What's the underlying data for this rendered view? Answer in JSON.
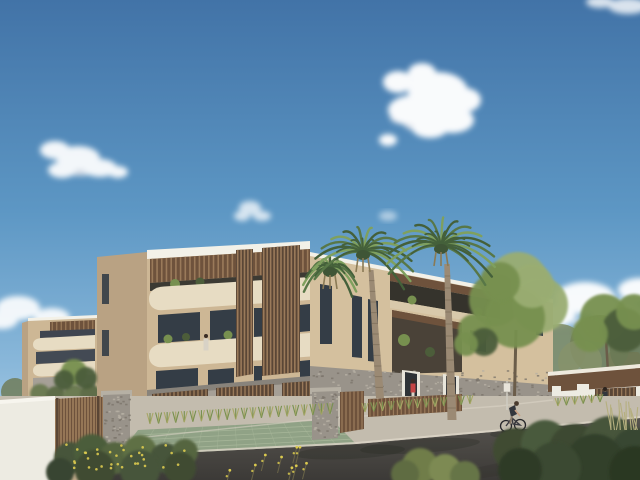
{
  "image": {
    "kind": "architectural-3d-rendering",
    "width": 640,
    "height": 480
  },
  "palette": {
    "sky_top": "#4273a7",
    "sky_mid": "#5d97c4",
    "sky_low": "#8ab8da",
    "sky_horizon": "#b9d6ec",
    "cloud": "#ffffff",
    "cloud_shade": "#d7dde6",
    "fascia": "#f3f1e8",
    "cream": "#e7dcc3",
    "cream_shade": "#d8c9ab",
    "beige": "#cdb795",
    "beige_sun": "#d4c09e",
    "beige_shade": "#b9a283",
    "wood": "#6e523c",
    "wood_light": "#9a7a5a",
    "wood_dark": "#5a4636",
    "window": "#343d46",
    "glass": "#8fa8ba",
    "concrete": "#a6a097",
    "stone": "#99938a",
    "stone_light": "#b6b0a4",
    "stone_dark": "#7c766c",
    "sidewalk": "#c3bcae",
    "curb": "#ddd6c8",
    "road_top": "#57544f",
    "road_bottom": "#3c3a37",
    "ramp": "#c0ab8b",
    "paver_green": "#90a286",
    "paver_line": "#a9b89b",
    "white_wall": "#edebe2",
    "leaf_light": "#9aad72",
    "leaf_mid": "#77904f",
    "leaf_dark": "#4c5d3a",
    "palm_green": "#53724489",
    "palm_stroke_a": "#587747",
    "palm_stroke_b": "#7fa05e",
    "palm_stroke_c": "#44603a",
    "trunk": "#9b8a74",
    "trunk_ring": "#7c6c58",
    "bush_dark": "#3f4c33",
    "grass_yellow": "#a8a766",
    "flower_yellow": "#dbca4f",
    "terracotta": "#9a6048",
    "skin": "#caa184",
    "red_top": "#c54545",
    "dark_fig": "#33363c",
    "shadow": "#23261e"
  },
  "scene": {
    "clouds": [
      {
        "name": "cloud-upper-right",
        "opacity": 0.97,
        "base": [
          [
            430,
            124,
            26,
            9
          ],
          [
            410,
            118,
            20,
            7
          ]
        ],
        "puffs": [
          [
            438,
            92,
            30,
            20
          ],
          [
            414,
            110,
            26,
            15
          ],
          [
            452,
            120,
            22,
            13
          ],
          [
            398,
            82,
            15,
            11
          ],
          [
            430,
            128,
            18,
            10
          ],
          [
            465,
            100,
            16,
            12
          ],
          [
            388,
            140,
            9,
            6
          ],
          [
            422,
            73,
            14,
            10
          ]
        ]
      },
      {
        "name": "cloud-left",
        "opacity": 0.93,
        "base": [
          [
            80,
            170,
            18,
            6
          ]
        ],
        "puffs": [
          [
            55,
            150,
            15,
            9
          ],
          [
            78,
            158,
            22,
            12
          ],
          [
            100,
            168,
            17,
            9
          ],
          [
            62,
            170,
            14,
            8
          ],
          [
            118,
            172,
            10,
            6
          ]
        ]
      },
      {
        "name": "cloud-small-center",
        "opacity": 0.75,
        "base": [],
        "puffs": [
          [
            250,
            208,
            11,
            7
          ],
          [
            262,
            216,
            9,
            5
          ],
          [
            242,
            216,
            8,
            5
          ]
        ]
      },
      {
        "name": "cloud-faint-center",
        "opacity": 0.5,
        "base": [],
        "puffs": [
          [
            388,
            216,
            9,
            5
          ]
        ]
      },
      {
        "name": "cloud-right-low",
        "opacity": 0.95,
        "base": [
          [
            600,
            324,
            26,
            8
          ]
        ],
        "puffs": [
          [
            585,
            298,
            30,
            16
          ],
          [
            618,
            314,
            26,
            14
          ],
          [
            556,
            316,
            20,
            11
          ],
          [
            640,
            290,
            22,
            12
          ],
          [
            600,
            330,
            24,
            10
          ]
        ]
      },
      {
        "name": "cloud-left-low",
        "opacity": 0.9,
        "base": [],
        "puffs": [
          [
            18,
            308,
            22,
            12
          ],
          [
            52,
            318,
            18,
            10
          ],
          [
            2,
            320,
            16,
            9
          ]
        ]
      },
      {
        "name": "cloud-top-right-corner",
        "opacity": 0.8,
        "base": [],
        "puffs": [
          [
            628,
            6,
            20,
            8
          ],
          [
            600,
            2,
            14,
            6
          ]
        ]
      }
    ],
    "slat_sets": [
      {
        "mount": "slats-main-pergola",
        "name": "main-pergola-slats",
        "pts": [
          [
            150,
            259
          ],
          [
            310,
            249
          ],
          [
            310,
            272
          ],
          [
            150,
            283
          ]
        ],
        "count": 34,
        "bg": "wood",
        "line": "wood_light",
        "w": 1.6
      },
      {
        "mount": "slats-leftwing-pergola",
        "name": "leftwing-pergola-slats",
        "pts": [
          [
            50,
            322
          ],
          [
            95,
            320
          ],
          [
            95,
            330
          ],
          [
            50,
            332
          ]
        ],
        "count": 10,
        "bg": "wood",
        "line": "wood_light",
        "w": 1.2
      },
      {
        "mount": "slats-panel1",
        "name": "facade-slat-screen-1",
        "pts": [
          [
            236,
            250
          ],
          [
            253,
            249
          ],
          [
            253,
            374
          ],
          [
            236,
            377
          ]
        ],
        "count": 5,
        "bg": "wood_dark",
        "line": "wood_light",
        "w": 1.6
      },
      {
        "mount": "slats-panel2",
        "name": "facade-slat-screen-2",
        "pts": [
          [
            262,
            248
          ],
          [
            300,
            245
          ],
          [
            300,
            372
          ],
          [
            262,
            376
          ]
        ],
        "count": 11,
        "bg": "wood_dark",
        "line": "wood_light",
        "w": 1.6
      },
      {
        "mount": "slats-g1",
        "name": "garage-screen-1",
        "pts": [
          [
            152,
            394
          ],
          [
            208,
            389
          ],
          [
            208,
            429
          ],
          [
            152,
            434
          ]
        ],
        "count": 14,
        "bg": "wood_dark",
        "line": "wood_light",
        "w": 1.4
      },
      {
        "mount": "slats-g2",
        "name": "garage-screen-2",
        "pts": [
          [
            216,
            388
          ],
          [
            274,
            384
          ],
          [
            274,
            425
          ],
          [
            216,
            430
          ]
        ],
        "count": 15,
        "bg": "wood_dark",
        "line": "wood_light",
        "w": 1.4
      },
      {
        "mount": "slats-g3",
        "name": "garage-screen-3",
        "pts": [
          [
            282,
            383
          ],
          [
            312,
            381
          ],
          [
            312,
            419
          ],
          [
            282,
            423
          ]
        ],
        "count": 8,
        "bg": "wood_dark",
        "line": "wood_light",
        "w": 1.4
      },
      {
        "mount": "slats-lowfence",
        "name": "street-low-fence",
        "pts": [
          [
            368,
            399
          ],
          [
            462,
            394
          ],
          [
            462,
            411
          ],
          [
            368,
            417
          ]
        ],
        "count": 24,
        "bg": "wood",
        "line": "wood_light",
        "w": 1.2
      },
      {
        "mount": "slats-gatepanel",
        "name": "driveway-gate-panel",
        "pts": [
          [
            340,
            392
          ],
          [
            364,
            391
          ],
          [
            364,
            429
          ],
          [
            340,
            433
          ]
        ],
        "count": 6,
        "bg": "wood",
        "line": "wood_light",
        "w": 1.3
      },
      {
        "mount": "slats-carport",
        "name": "carport-opening-slats",
        "pts": [
          [
            595,
            389
          ],
          [
            636,
            387
          ],
          [
            636,
            410
          ],
          [
            595,
            412
          ]
        ],
        "count": 10,
        "bg": "wood_dark",
        "line": "wood_light",
        "w": 1.2
      },
      {
        "mount": "slats-leftfence",
        "name": "timber-fence-slats",
        "pts": [
          [
            55,
            399
          ],
          [
            103,
            396
          ],
          [
            103,
            451
          ],
          [
            55,
            456
          ]
        ],
        "count": 16,
        "bg": "wood_light",
        "line": "wood",
        "w": 1.2
      }
    ],
    "speckle_areas": [
      {
        "mount": "speckles-stone",
        "name": "stone-cladding-texture",
        "x": 312,
        "y": 370,
        "w": 238,
        "h": 30,
        "n": 160,
        "seed": 7
      },
      {
        "mount": "speckles-pillar",
        "name": "stone-pillar-texture",
        "x": 104,
        "y": 396,
        "w": 25,
        "h": 54,
        "n": 60,
        "seed": 11
      },
      {
        "mount": "speckles-midwall",
        "name": "stone-wall-texture",
        "x": 313,
        "y": 393,
        "w": 25,
        "h": 44,
        "n": 50,
        "seed": 13
      }
    ],
    "palms": [
      {
        "mount": "palm3",
        "name": "palm-tree-small",
        "cx": 330,
        "cy": 269,
        "r": 27,
        "n": 12,
        "trunk": null,
        "rings": 0
      },
      {
        "mount": "palms",
        "name": "palm-tree-left",
        "cx": 363,
        "cy": 252,
        "r": 50,
        "n": 15,
        "trunk": [
          371,
          270,
          380,
          398,
          5,
          8
        ],
        "rings": 12
      },
      {
        "mount": "palms",
        "name": "palm-tree-right",
        "cx": 441,
        "cy": 246,
        "r": 54,
        "n": 16,
        "trunk": [
          447,
          264,
          452,
          420,
          5.5,
          9
        ],
        "rings": 13
      }
    ],
    "tree_clusters": [
      {
        "mount": "trees",
        "name": "tree-large-center-right",
        "trunk": [
          514,
          418,
          516,
          330,
          3
        ],
        "circles": [
          [
            518,
            282,
            30,
            "leaf_light"
          ],
          [
            495,
            300,
            26,
            "leaf_mid"
          ],
          [
            540,
            305,
            28,
            "leaf_light"
          ],
          [
            515,
            318,
            30,
            "leaf_mid"
          ],
          [
            532,
            286,
            22,
            "leaf_light"
          ],
          [
            500,
            282,
            20,
            "leaf_mid"
          ]
        ]
      },
      {
        "mount": "trees",
        "name": "tree-small-center",
        "trunk": null,
        "circles": [
          [
            474,
            330,
            16,
            "leaf_mid"
          ],
          [
            484,
            342,
            14,
            "leaf_dark"
          ],
          [
            466,
            344,
            12,
            "leaf_mid"
          ]
        ]
      },
      {
        "mount": "trees",
        "name": "tree-right-edge",
        "trunk": [
          608,
          372,
          606,
          340,
          2.5
        ],
        "circles": [
          [
            604,
            318,
            24,
            "leaf_mid"
          ],
          [
            624,
            330,
            22,
            "leaf_dark"
          ],
          [
            590,
            334,
            18,
            "leaf_mid"
          ],
          [
            634,
            312,
            18,
            "leaf_mid"
          ]
        ]
      },
      {
        "mount": "trees",
        "name": "tree-left-small",
        "trunk": null,
        "circles": [
          [
            74,
            372,
            13,
            "leaf_mid"
          ],
          [
            86,
            378,
            11,
            "leaf_dark"
          ],
          [
            64,
            380,
            10,
            "leaf_dark"
          ]
        ]
      }
    ],
    "bush_clusters": [
      {
        "mount": "bushes-left",
        "name": "foreground-shrubs-left",
        "circles": [
          [
            70,
            458,
            16,
            "#46543a"
          ],
          [
            92,
            452,
            18,
            "#4c5d3a"
          ],
          [
            115,
            458,
            16,
            "#55653f"
          ],
          [
            140,
            452,
            17,
            "#5e6f45"
          ],
          [
            165,
            458,
            15,
            "#46543a"
          ],
          [
            185,
            452,
            13,
            "#55653f"
          ],
          [
            95,
            470,
            20,
            "#3f4c33"
          ],
          [
            140,
            470,
            20,
            "#46553a"
          ],
          [
            180,
            468,
            16,
            "#3f4c33"
          ],
          [
            60,
            472,
            14,
            "#384430"
          ]
        ]
      },
      {
        "mount": "grasses-center",
        "name": "foreground-grasses-center",
        "circles": [
          [
            420,
            466,
            18,
            "#6f7d4a"
          ],
          [
            445,
            470,
            16,
            "#7d8a52"
          ],
          [
            405,
            474,
            14,
            "#5e6c42"
          ],
          [
            465,
            476,
            15,
            "#667446"
          ]
        ]
      },
      {
        "mount": "bushes-right",
        "name": "foreground-bushes-right",
        "circles": [
          [
            515,
            450,
            22,
            "#3f4c33"
          ],
          [
            545,
            444,
            24,
            "#4a5a3c"
          ],
          [
            575,
            450,
            26,
            "#3c4a32"
          ],
          [
            610,
            444,
            28,
            "#46553a"
          ],
          [
            635,
            452,
            24,
            "#394733"
          ],
          [
            595,
            464,
            30,
            "#323f2b"
          ],
          [
            555,
            468,
            26,
            "#3a4830"
          ],
          [
            520,
            470,
            22,
            "#2f3b28"
          ],
          [
            635,
            472,
            26,
            "#2c3724"
          ]
        ]
      },
      {
        "mount": "hedge-left",
        "name": "hedge-left-wing",
        "circles": [
          [
            40,
            394,
            10,
            "#6d7b52"
          ],
          [
            56,
            396,
            10,
            "#5f6d48"
          ],
          [
            74,
            396,
            11,
            "#6d7b52"
          ],
          [
            90,
            394,
            10,
            "#5f6d48"
          ],
          [
            138,
            414,
            9,
            "#4c5d3a"
          ],
          [
            141,
            428,
            10,
            "#46553a"
          ],
          [
            137,
            442,
            9,
            "#3f4c33"
          ]
        ]
      },
      {
        "mount": "carport-bushes",
        "name": "bushes-by-carport",
        "circles": [
          [
            565,
            412,
            13,
            "#55653f"
          ],
          [
            582,
            417,
            14,
            "#4c5d3a"
          ],
          [
            552,
            416,
            10,
            "#5e6f45"
          ]
        ]
      }
    ],
    "grass_rows": [
      {
        "name": "grass-row-driveway",
        "x1": 150,
        "y1": 424,
        "x2": 330,
        "y2": 414,
        "n": 22,
        "h": 11
      },
      {
        "name": "grass-row-right",
        "x1": 365,
        "y1": 412,
        "x2": 470,
        "y2": 404,
        "n": 13,
        "h": 9
      },
      {
        "name": "grass-row-far-right",
        "x1": 558,
        "y1": 406,
        "x2": 600,
        "y2": 402,
        "n": 6,
        "h": 8
      }
    ],
    "flower_area": {
      "name": "yellow-flowers",
      "x": 62,
      "y": 444,
      "w": 126,
      "h": 26,
      "n": 34,
      "seed": 21
    },
    "twigs": {
      "name": "flowering-twigs",
      "x": 218,
      "y": 452,
      "w": 104,
      "h": 26,
      "n": 9,
      "seed": 31
    },
    "tall_grass": {
      "name": "tall-grass-right",
      "x": 610,
      "y": 430,
      "w": 30,
      "n": 12,
      "len": 24,
      "seed": 41
    },
    "driveway_grid": {
      "name": "paver-grid",
      "tl": [
        138,
        430
      ],
      "tr": [
        332,
        420
      ],
      "br": [
        356,
        444
      ],
      "bl": [
        118,
        456
      ],
      "rows": 5,
      "cols": 12
    }
  }
}
